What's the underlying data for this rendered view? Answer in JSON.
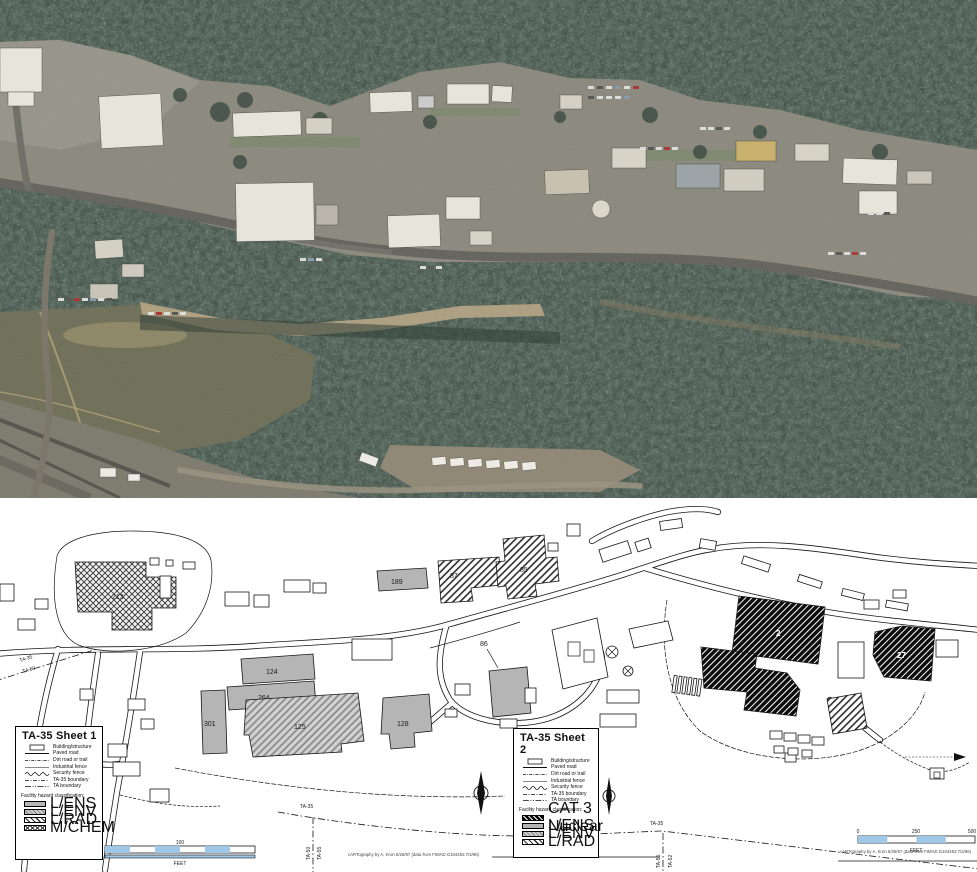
{
  "palette": {
    "forest_dark": "#43534a",
    "forest_speckle": "#1f2b25",
    "forest_light": "#6c7f72",
    "field_olive": "#6f6f58",
    "cliff_tan": "#b7a584",
    "pavement": "#8b897e",
    "roof_white": "#e9e6dc",
    "roof_tan": "#c9b06a",
    "map_background": "#ffffff",
    "lens_gray": "#b5b5b5",
    "scalebar_blue": "#9fc8e8"
  },
  "map": {
    "legend_sheet1": {
      "title": "TA-35 Sheet 1",
      "line_items": [
        "Building/structure",
        "Paved road",
        "Dirt road or trail",
        "Industrial fence",
        "Security fence",
        "TA-35 boundary",
        "TA boundary"
      ],
      "hazard_heading": "Facility hazard classification:",
      "hazard_items": [
        "L/ENS",
        "L/ENV",
        "L/RAD",
        "M/CHEM"
      ]
    },
    "legend_sheet2": {
      "title": "TA-35 Sheet 2",
      "line_items": [
        "Building/structure",
        "Paved road",
        "Dirt road or trail",
        "Industrial fence",
        "Security fence",
        "TA-35 boundary",
        "TA boundary"
      ],
      "hazard_heading": "Facility hazard classification:",
      "hazard_items": [
        "CAT 3 Nuclear",
        "L/ENS",
        "L/ENV",
        "L/RAD"
      ]
    },
    "buildings": [
      {
        "label": "213",
        "hazard": "M/CHEM"
      },
      {
        "label": "124",
        "hazard": "L/ENS"
      },
      {
        "label": "264",
        "hazard": "L/ENS"
      },
      {
        "label": "125",
        "hazard": "L/ENV"
      },
      {
        "label": "301",
        "hazard": "L/ENS"
      },
      {
        "label": "128",
        "hazard": "L/ENS"
      },
      {
        "label": "189",
        "hazard": "L/ENS"
      },
      {
        "label": "87",
        "hazard": "L/RAD"
      },
      {
        "label": "85",
        "hazard": "L/RAD"
      },
      {
        "label": "86",
        "hazard": "L/ENS"
      },
      {
        "label": "2",
        "hazard": "CAT 3 Nuclear"
      },
      {
        "label": "27",
        "hazard": "CAT 3 Nuclear"
      }
    ],
    "ta_labels": [
      "TA-35",
      "TA-50",
      "TA-35",
      "TA-50",
      "TA-55",
      "TA-35",
      "TA-55",
      "TA-52"
    ],
    "scalebar_west": {
      "tick_mid": "100",
      "unit": "FEET"
    },
    "scalebar_east": {
      "tick0": "0",
      "tick1": "250",
      "tick2": "500",
      "unit": "FEET"
    },
    "credit_center": "cARTography by A. Kron 6/26/97 (data from FIMAD G104453 7/2/96)",
    "credit_east": "cARTography by A. Kron 6/26/97 (data from FIMAD G104453 7/2/96)"
  }
}
